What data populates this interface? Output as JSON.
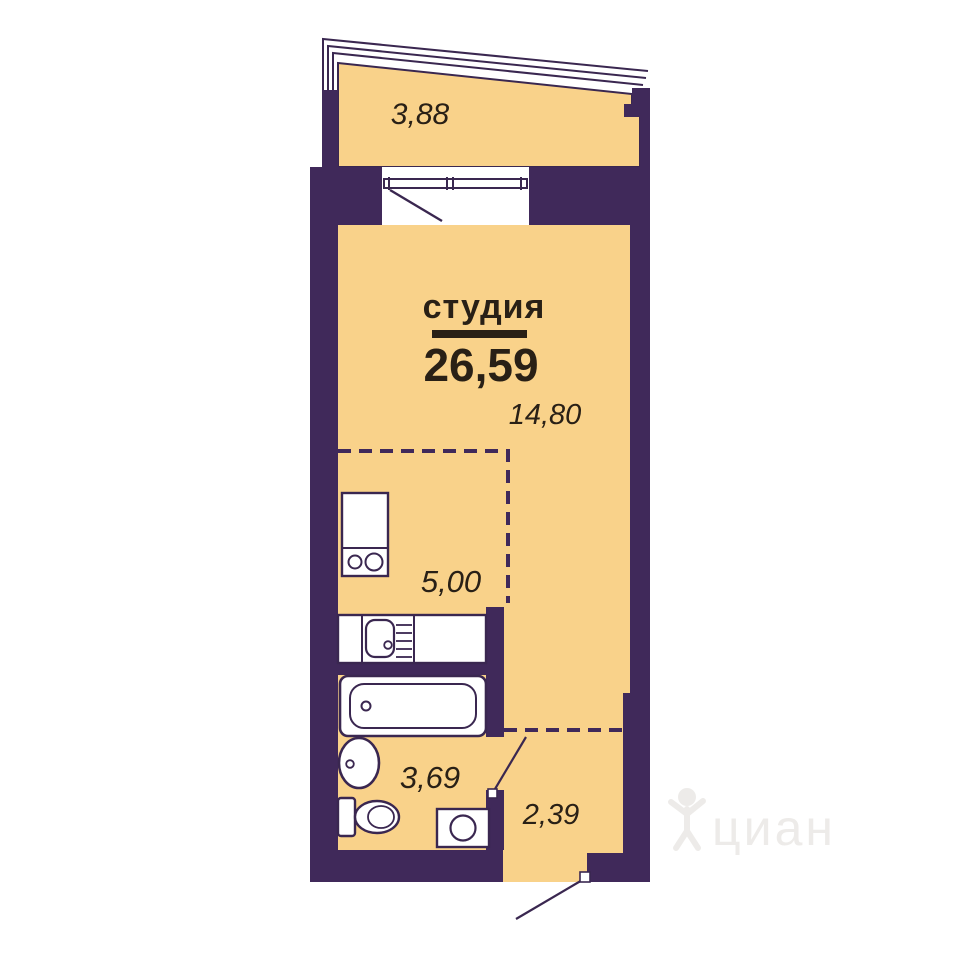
{
  "plan": {
    "title": "студия",
    "total_area": "26,59",
    "areas": {
      "balcony": "3,88",
      "living": "14,80",
      "kitchen": "5,00",
      "bathroom": "3,69",
      "hallway": "2,39"
    }
  },
  "watermark": {
    "text": "циан"
  },
  "colors": {
    "wall": "#40295A",
    "floor": "#F9D28A",
    "line": "#3A2750",
    "text": "#292016",
    "white": "#FFFFFF",
    "watermark": "#E2DFDB"
  }
}
